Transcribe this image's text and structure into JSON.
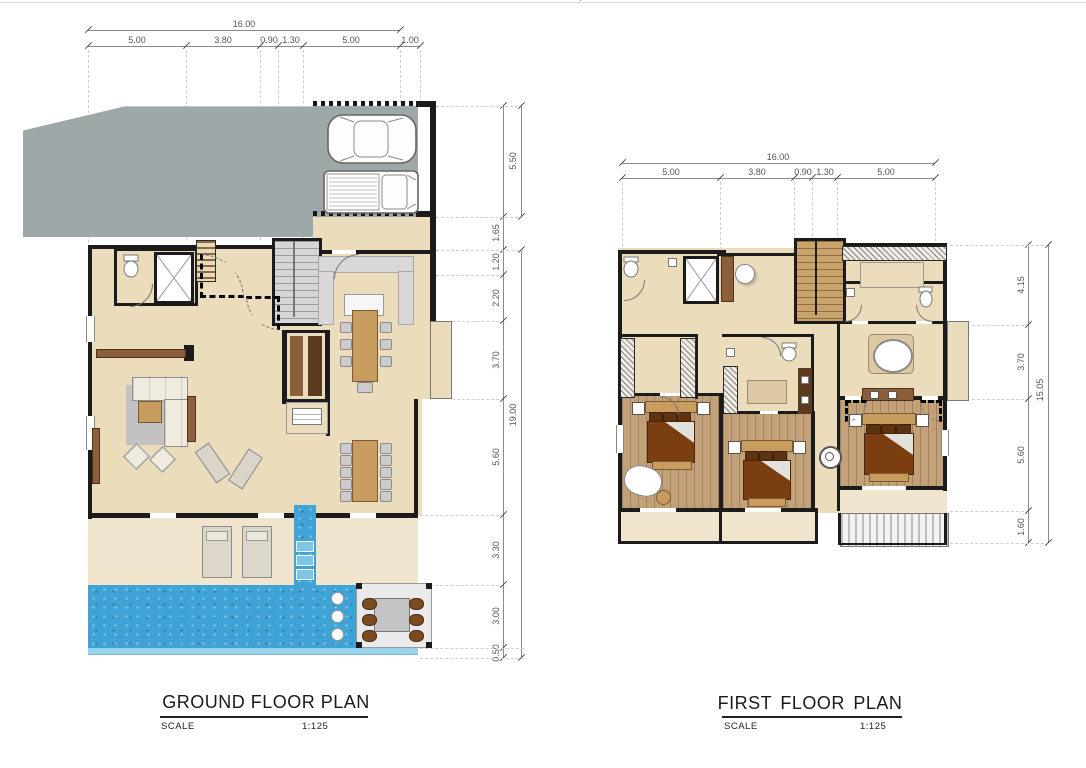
{
  "colors": {
    "paper": "#ffffff",
    "wall": "#1b1b1b",
    "floor": "#ebdcbc",
    "floor-light": "#f1e6cd",
    "wood": "#c2a078",
    "drive": "#9fa8a8",
    "pool": "#3fa3d6",
    "pool-light": "#9ad4ec",
    "counter": "#d8d8d8",
    "table": "#c89b5e",
    "cab-dark": "#5c3a1e",
    "cab-mid": "#8b5e3c",
    "bed": "#7b3e10",
    "pillow": "#5e3312",
    "chair": "#cccccc",
    "seat": "#7a4a21",
    "rug": "#c2c2c2",
    "cream": "#efebde",
    "stair": "#d6d6d6",
    "stair-wood": "#c9a36b",
    "dim-line": "#8a8a8a",
    "dim-text": "#555555",
    "dash": "#cfcfcf",
    "title": "#1a1a1a"
  },
  "plans": [
    {
      "id": "ground",
      "title": "GROUND FLOOR PLAN",
      "scale_label": "SCALE",
      "scale_value": "1:125",
      "dims_top": {
        "total": "16.00",
        "segments": [
          "5.00",
          "3.80",
          "0.90",
          "1.30",
          "5.00",
          "1.00"
        ]
      },
      "dims_right": {
        "total": "19.00",
        "segments": [
          "5.50",
          "1.65",
          "1.20",
          "2.20",
          "3.70",
          "5.60",
          "3.30",
          "3.00",
          "0.50"
        ]
      },
      "features": [
        "driveway",
        "carport-2-cars",
        "entry-walk",
        "wc",
        "elevator",
        "storage-shelves",
        "staircase",
        "kitchen-counter",
        "kitchen-island",
        "dining-table-8-seats",
        "pantry",
        "living-sofa-set",
        "tv-cabinet",
        "dining-table-10-seats",
        "lounge-chairs",
        "terrace-sun-loungers",
        "water-steps",
        "swimming-pool",
        "sunken-pool-dining-6-seats",
        "bay-window"
      ]
    },
    {
      "id": "first",
      "title": "FIRST  FLOOR  PLAN",
      "scale_label": "SCALE",
      "scale_value": "1:125",
      "dims_top": {
        "total": "16.00",
        "segments": [
          "5.00",
          "3.80",
          "0.90",
          "1.30",
          "5.00"
        ]
      },
      "dims_right": {
        "total": "15.05",
        "segments": [
          "4.15",
          "3.70",
          "5.60",
          "1.60"
        ]
      },
      "features": [
        "bathroom",
        "elevator",
        "round-basin",
        "staircase",
        "master-closet",
        "wc-left",
        "wc-right",
        "master-bath-tub",
        "bay-window",
        "walk-in-wardrobe",
        "bathroom-2",
        "bedroom-1",
        "bedroom-2",
        "master-bedroom",
        "tv-bench",
        "balcony",
        "sun-deck",
        "column-fixture"
      ]
    }
  ]
}
